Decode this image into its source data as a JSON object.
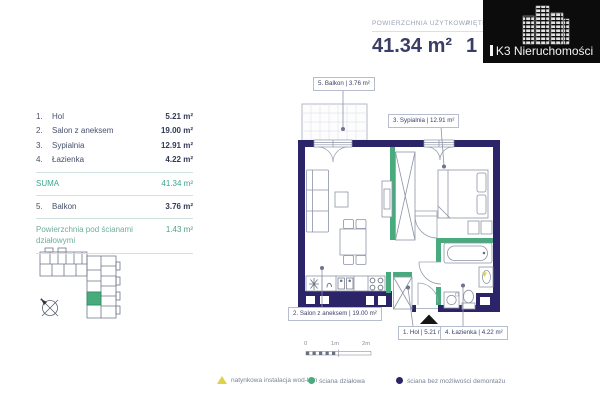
{
  "header": {
    "stat1": {
      "label": "POWIERZCHNIA UŻYTKOWA",
      "value": "41.34 m²"
    },
    "stat2": {
      "label": "PIĘTRO",
      "value": "1"
    },
    "logo_text": "K3 Nieruchomości"
  },
  "rooms_table": {
    "rows": [
      {
        "num": "1.",
        "name": "Hol",
        "area": "5.21 m²"
      },
      {
        "num": "2.",
        "name": "Salon z aneksem",
        "area": "19.00 m²"
      },
      {
        "num": "3.",
        "name": "Sypialnia",
        "area": "12.91 m²"
      },
      {
        "num": "4.",
        "name": "Łazienka",
        "area": "4.22 m²"
      }
    ],
    "suma": {
      "label": "SUMA",
      "value": "41.34 m²"
    },
    "balkon": {
      "num": "5.",
      "name": "Balkon",
      "area": "3.76 m²"
    },
    "partition": {
      "label": "Powierzchnia pod ścianami działowymi",
      "value": "1.43 m²"
    }
  },
  "plan": {
    "labels": {
      "balkon": "5. Balkon | 3.76 m²",
      "sypialnia": "3. Sypialnia | 12.91 m²",
      "salon": "2. Salon z aneksem | 19.00 m²",
      "hol": "1. Hol | 5.21 m²",
      "lazienka": "4. Łazienka | 4.22 m²"
    }
  },
  "scale": {
    "t0": "0",
    "t1": "1m",
    "t2": "2m"
  },
  "legend": {
    "items": [
      {
        "shape": "triangle",
        "color": "#ddd24a",
        "label": "natynkowa instalacja wod-kan"
      },
      {
        "shape": "circle",
        "color": "#47ab7d",
        "label": "ściana działowa"
      },
      {
        "shape": "circle",
        "color": "#2c2468",
        "label": "ściana bez możliwości demontażu"
      }
    ]
  },
  "colors": {
    "wall_navy": "#2c2468",
    "partition_green": "#47ab7d",
    "accent_teal": "#3aa58d",
    "marker_yellow": "#ddd24a"
  }
}
